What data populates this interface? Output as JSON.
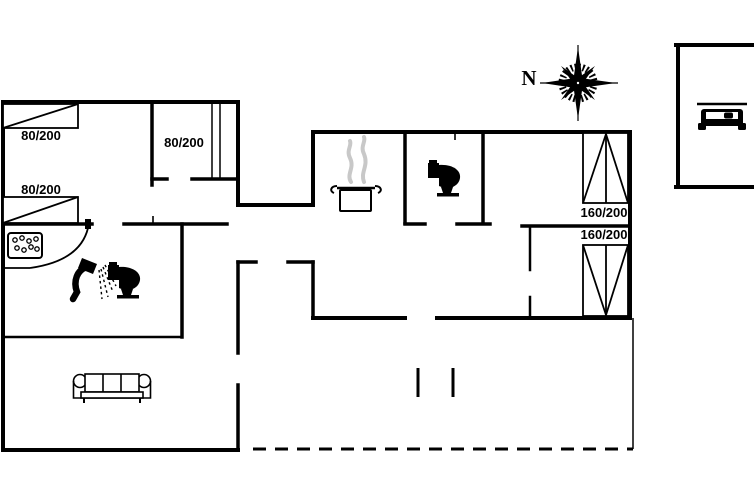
{
  "colors": {
    "background": "#ffffff",
    "ink": "#000000",
    "steam": "#c8c8c8"
  },
  "bed_labels": {
    "single_bed_1": "80/200",
    "single_bed_2": "80/200",
    "single_bed_3": "80/200",
    "double_bed_1": "160/200",
    "double_bed_2": "160/200"
  },
  "compass": {
    "north_label": "N"
  },
  "icons": {
    "whirlpool": "whirlpool-icon",
    "shower": "shower-icon",
    "bathroom_toilet": "toilet-icon",
    "wc_toilet": "toilet-icon",
    "cooking_pot": "cooking-pot-icon",
    "sofa": "sofa-icon",
    "car": "car-icon",
    "compass_rose": "compass-rose-icon",
    "wardrobe": "wardrobe-icon"
  }
}
